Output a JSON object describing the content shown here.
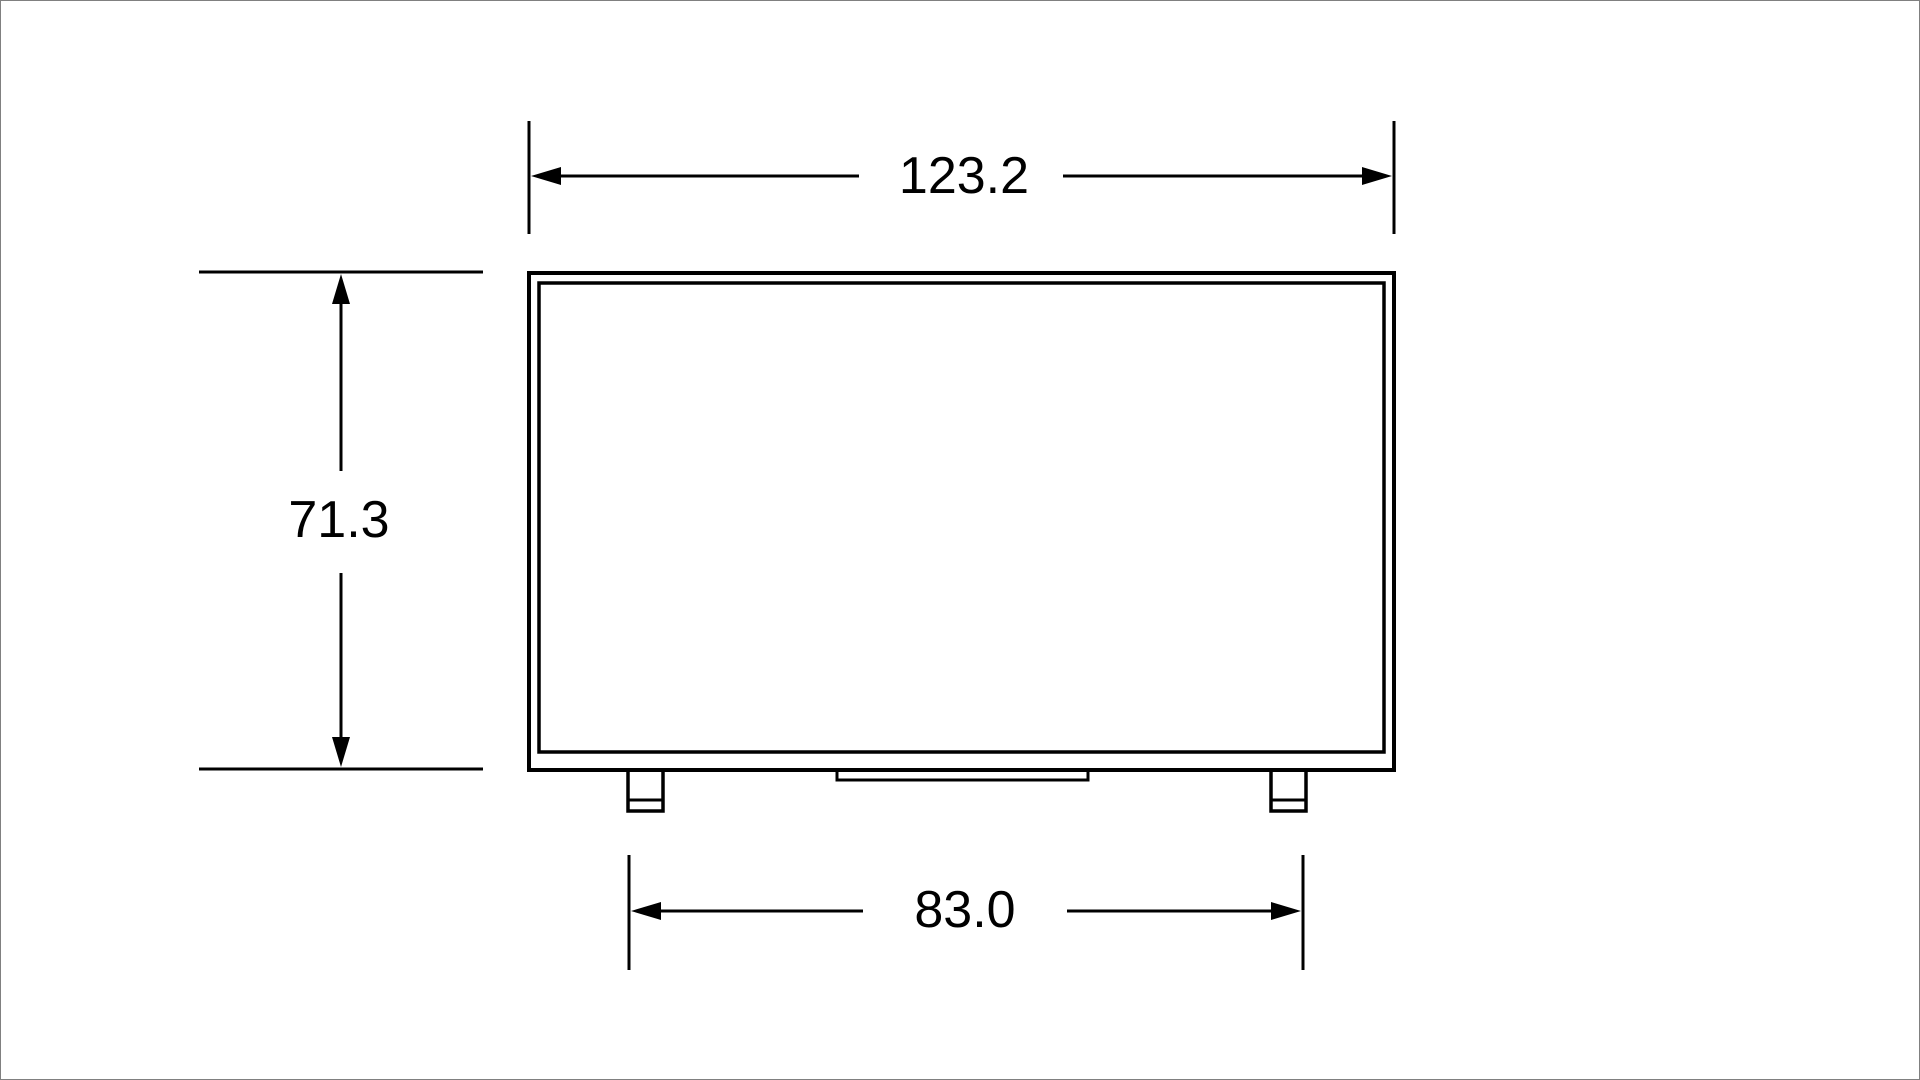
{
  "page": {
    "background": "#ffffff",
    "border_color": "#808080"
  },
  "drawing": {
    "type": "dimension-drawing",
    "subject": "flat-panel display front view with stand feet",
    "line_color": "#000000",
    "dimensions": {
      "overall_width": "123.2",
      "overall_height": "71.3",
      "stand_width": "83.0"
    }
  }
}
